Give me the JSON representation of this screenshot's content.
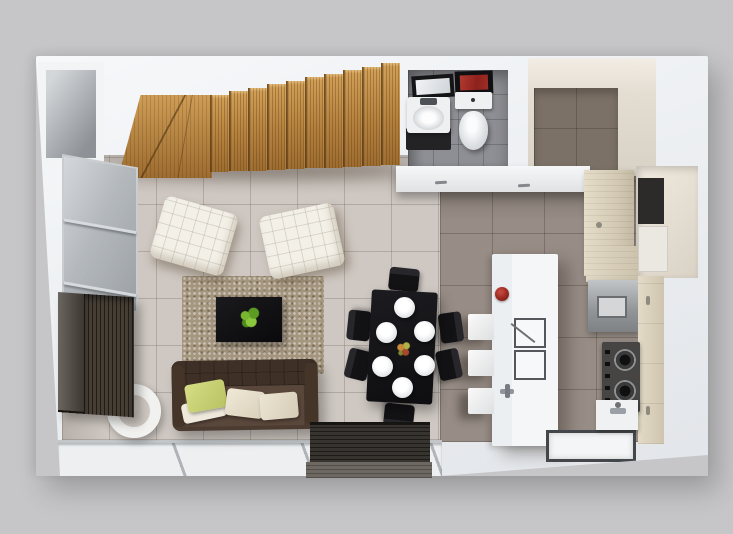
{
  "meta": {
    "description": "Top-down 3D rendered floor plan of a small apartment",
    "no_visible_text": true
  },
  "palette": {
    "bg": "#c6c6c8",
    "wall": "#eef1f4",
    "floor_living": "#cfc8c2",
    "floor_kitchen": "#978d86",
    "floor_bath": "#8e8f94",
    "wood_light": "#cf9d55",
    "wood_dark": "#9d6c2f",
    "wood_cabinet": "#d8cfba",
    "rug": "#a5967f",
    "sofa": "#4c3b31",
    "sofa_seat": "#5a473b",
    "cushion_green": "#b9c263",
    "cushion_cream": "#d9d0ba",
    "lounge_white": "#f3f0e8",
    "table_black": "#0e0e11",
    "plant_green": "#6fae2c",
    "island_white": "#f4f6f8",
    "bowl_red": "#9c2a22",
    "art_red": "#a12e27",
    "steel": "#9a9ea1",
    "cooktop": "#474543",
    "sideboard": "#463e35",
    "glass": "#b4b9bd",
    "terrace": "#edeff1",
    "platform": "#37332e",
    "appliance_dark": "#2c2b29",
    "dressing_wall": "#7c7166"
  },
  "scene": {
    "view": "top-down axonometric render on gray backdrop",
    "rooms": [
      {
        "name": "staircase",
        "items": [
          "wood winder landing",
          "10 straight wood treads ascending right"
        ]
      },
      {
        "name": "bathroom",
        "items": [
          "framed mirror",
          "white vanity sink on dark cabinet",
          "toilet",
          "red framed wall art",
          "gray tile floor"
        ]
      },
      {
        "name": "dressing-room",
        "items": [
          "dark taupe tiled back wall",
          "beige walls"
        ]
      },
      {
        "name": "living-room",
        "items": [
          "2 white tufted lounge chairs",
          "black coffee table",
          "green potted plant",
          "speckled brown area rug",
          "dark brown tufted sofa",
          "1 green pillow",
          "2 cream pillows",
          "1 white pillow",
          "white ring side table",
          "dark slatted sideboard",
          "glass sliding door",
          "beige tile floor"
        ]
      },
      {
        "name": "dining-area",
        "items": [
          "black dining table",
          "6 black chairs",
          "6 white round plates",
          "flower centerpiece"
        ]
      },
      {
        "name": "kitchen",
        "items": [
          "white island with red bowl, double sink and faucet",
          "3 white bar stools",
          "back counter with handles",
          "light wood pantry cabinet",
          "utility niche with dark appliance",
          "stainless steel appliance",
          "gas cooktop with 2 burners and 5 knobs",
          "light wood cabinet strip",
          "bottom sink counter with faucet",
          "recessed dark-bordered floor tile",
          "taupe tile floor"
        ]
      },
      {
        "name": "terrace-strip",
        "items": [
          "white floor panels with diagonal seams",
          "dark wood entry platform"
        ]
      }
    ],
    "counts": {
      "stair_treads": 10,
      "dining_plates": 6,
      "dining_chairs": 6,
      "bar_stools": 3,
      "lounge_chairs": 2,
      "sofa_pillows": 4
    }
  }
}
